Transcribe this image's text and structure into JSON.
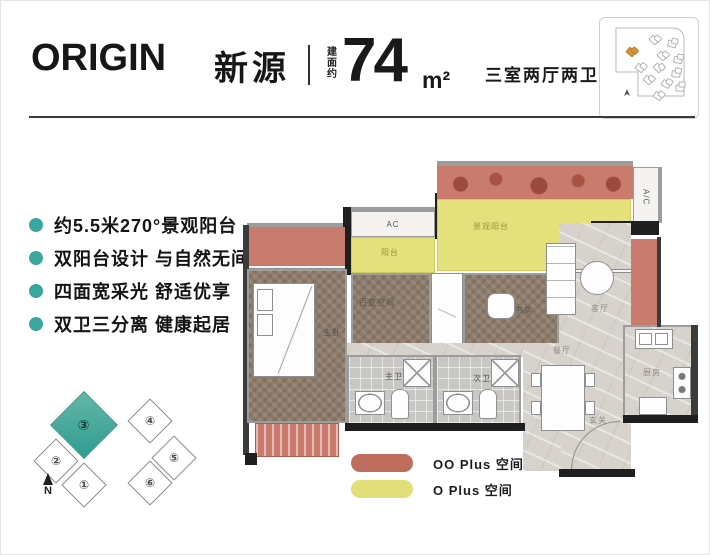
{
  "header": {
    "logo": "ORIGIN",
    "name": "新源",
    "area_prefix": "建面约",
    "area_value": "74",
    "area_unit": "m²",
    "layout_text": "三室两厅两卫"
  },
  "features": {
    "items": [
      "约5.5米270°景观阳台",
      "双阳台设计 与自然无间",
      "四面宽采光 舒适优享",
      "双卫三分离 健康起居"
    ]
  },
  "building": {
    "units": [
      "①",
      "②",
      "③",
      "④",
      "⑤",
      "⑥"
    ],
    "highlighted_unit": "③",
    "north_label": "N"
  },
  "plan": {
    "labels": {
      "master": "主卧",
      "flex": "百变空间",
      "study": "书房",
      "living": "客厅",
      "dining": "餐厅",
      "foyer": "玄关",
      "kitchen": "厨房",
      "bath_master": "主卫",
      "bath_second": "次卫",
      "balcony": "阳台",
      "view_balcony": "景观阳台",
      "ac": "AC",
      "ac_side": "A/C"
    }
  },
  "legend": {
    "items": [
      {
        "label": "OO Plus 空间",
        "color": "#bf6e5d"
      },
      {
        "label": "O Plus 空间",
        "color": "#e2df7b"
      }
    ]
  },
  "colors": {
    "accent_teal": "#3aa79f",
    "overlay_red": "#c97b6e",
    "overlay_yellow": "#e4e17c",
    "site_highlight": "#d7953c"
  }
}
